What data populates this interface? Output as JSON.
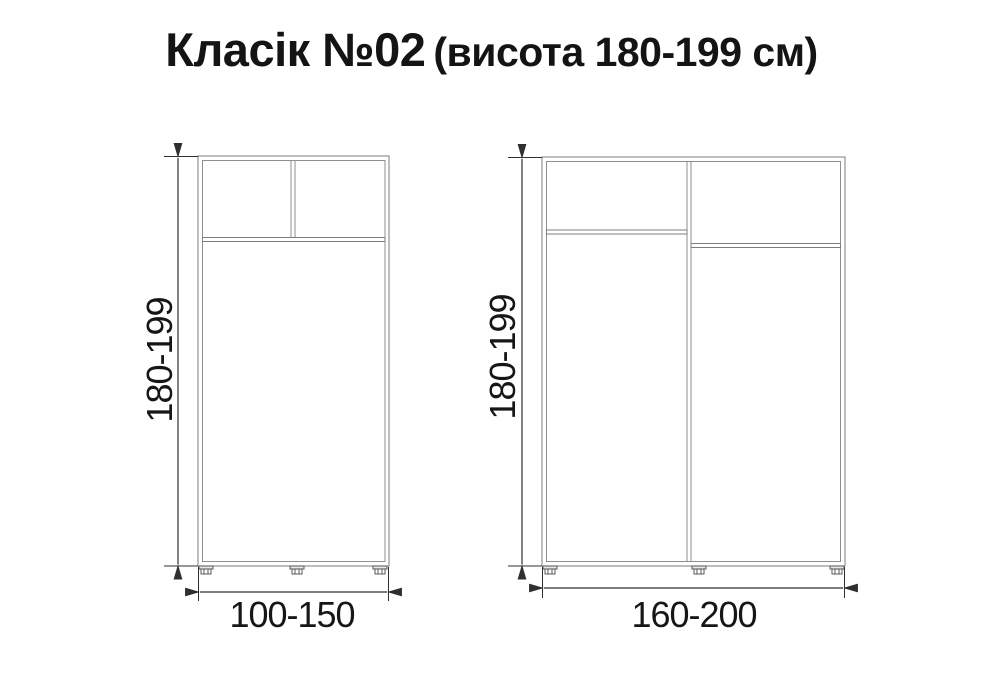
{
  "title": {
    "main": "Класік №02",
    "sub": "(висота 180-199 см)"
  },
  "wardrobes": {
    "small": {
      "height_label": "180-199",
      "width_label": "100-150"
    },
    "large": {
      "height_label": "180-199",
      "width_label": "160-200"
    }
  },
  "colors": {
    "background": "#ffffff",
    "cabinet_outline": "#8f8f8f",
    "dimension_line": "#2f2f2f",
    "text": "#141414"
  }
}
